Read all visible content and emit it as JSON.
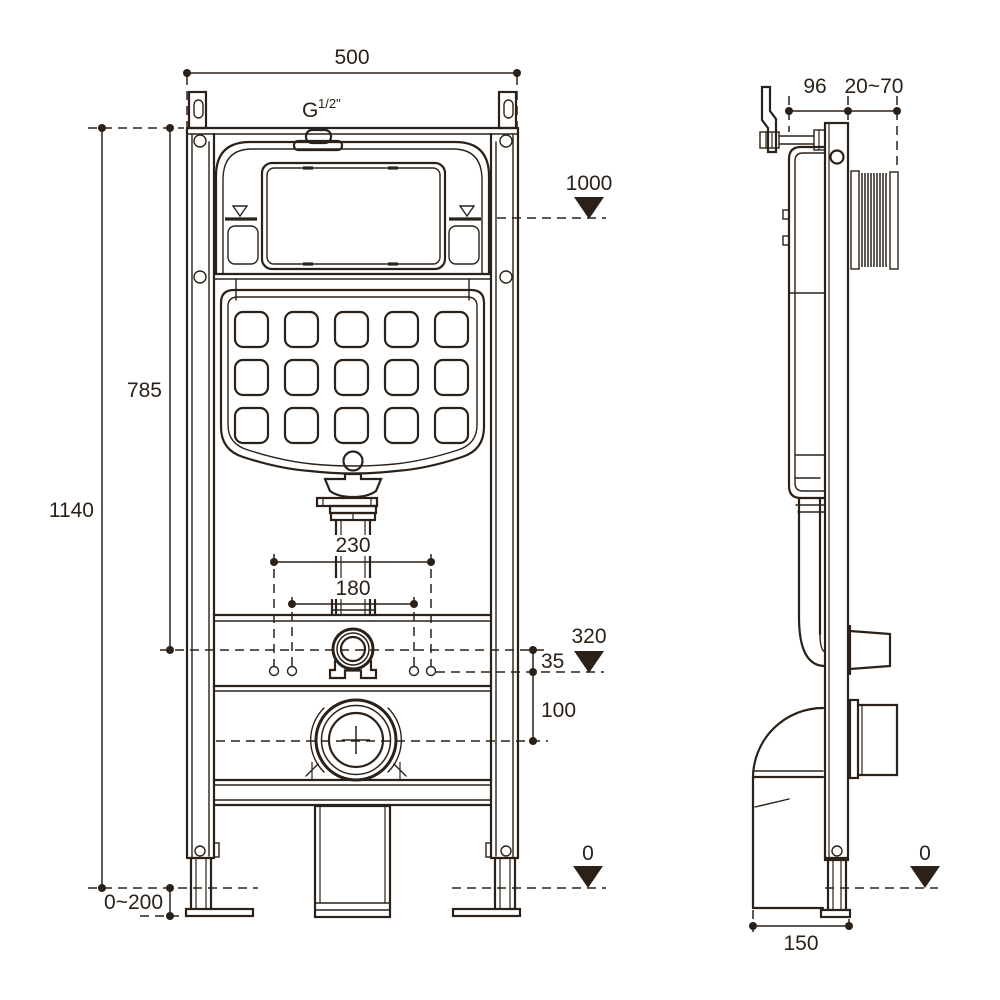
{
  "title": "Wall-hung WC concealed cistern frame installation drawing",
  "colors": {
    "line": "#2b2118",
    "background": "#ffffff"
  },
  "front_view": {
    "dim_width_top": "500",
    "inlet_thread_base": "G",
    "inlet_thread_sup": "1/2\"",
    "level_cistern_water": "1000",
    "dim_height_inlet": "785",
    "dim_height_frame": "1140",
    "dim_fixing_outer": "230",
    "dim_fixing_inner": "180",
    "level_flush_bend": "320",
    "dim_offset_inlet": "35",
    "dim_offset_outlet": "100",
    "dim_foot_adjust": "0~200",
    "level_floor": "0"
  },
  "side_view": {
    "dim_depth_frame": "96",
    "dim_wall_clearance": "20~70",
    "level_floor": "0",
    "dim_base_depth": "150"
  }
}
